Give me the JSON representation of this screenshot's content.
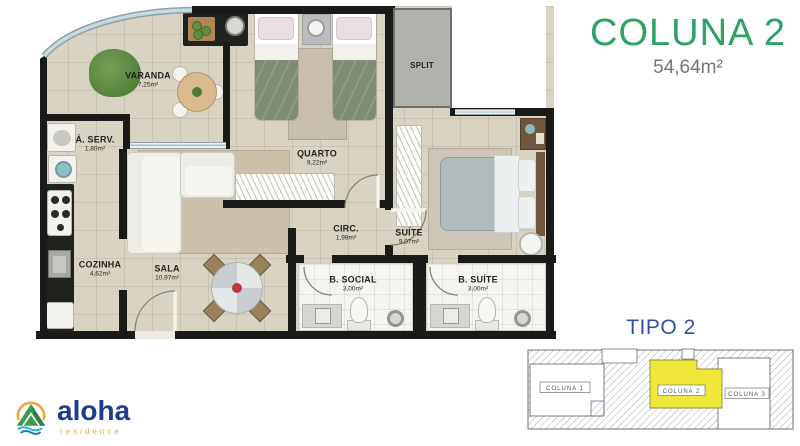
{
  "header": {
    "title": "COLUNA 2",
    "area": "54,64m²"
  },
  "plan": {
    "rooms": {
      "varanda": {
        "label": "VARANDA",
        "area": "7,25m²"
      },
      "a_serv": {
        "label": "Á. SERV.",
        "area": "1,80m²"
      },
      "cozinha": {
        "label": "COZINHA",
        "area": "4,62m²"
      },
      "sala": {
        "label": "SALA",
        "area": "10,97m²"
      },
      "quarto": {
        "label": "QUARTO",
        "area": "9,22m²"
      },
      "circ": {
        "label": "CIRC.",
        "area": "1,98m²"
      },
      "suite": {
        "label": "SUÍTE",
        "area": "9,07m²"
      },
      "b_social": {
        "label": "B. SOCIAL",
        "area": "3,00m²"
      },
      "b_suite": {
        "label": "B. SUÍTE",
        "area": "3,00m²"
      },
      "split": {
        "label": "SPLIT"
      }
    }
  },
  "keyplan": {
    "title": "TIPO 2",
    "units": [
      {
        "label": "COLUNA 1",
        "highlighted": false
      },
      {
        "label": "COLUNA 2",
        "highlighted": true
      },
      {
        "label": "COLUNA 3",
        "highlighted": false
      }
    ]
  },
  "logo": {
    "brand": "aloha",
    "tagline": "residence"
  },
  "colors": {
    "accent_green": "#2ca263",
    "accent_blue": "#2f4fa0",
    "brand_navy": "#1c3c90",
    "brand_orange": "#f0a43c",
    "highlight_yellow": "#efe73a",
    "floor_beige": "#d9d3c4",
    "wall_black": "#1a1a18"
  }
}
